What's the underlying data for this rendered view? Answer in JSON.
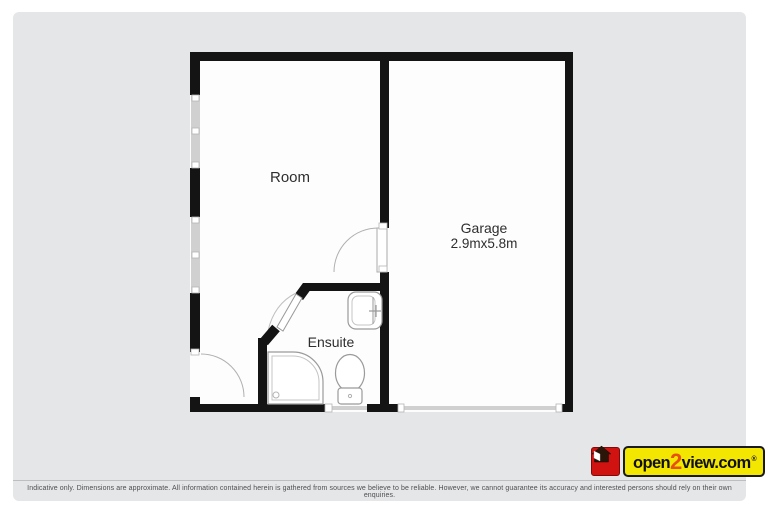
{
  "page": {
    "background": "#ffffff",
    "card_background": "#e5e6e8"
  },
  "floorplan": {
    "rooms": {
      "room": {
        "label": "Room"
      },
      "garage": {
        "label": "Garage",
        "dims": "2.9mx5.8m"
      },
      "ensuite": {
        "label": "Ensuite"
      }
    },
    "icons": [
      "window-icon",
      "door-swing-icon",
      "shower-icon",
      "toilet-icon",
      "sink-icon",
      "garage-door-icon"
    ],
    "colors": {
      "wall": "#141414",
      "window": "#d0d0d0",
      "fixture_outline": "#9a9a9a",
      "floor": "#fdfdfd"
    }
  },
  "branding": {
    "open": "open",
    "two": "2",
    "view": "view.com",
    "reg": "®",
    "colors": {
      "logo_red": "#d01310",
      "logo_yellow": "#f3e600",
      "logo_accent": "#e8500f"
    }
  },
  "footer": {
    "disclaimer": "Indicative only. Dimensions are approximate. All information contained herein is gathered from sources we believe to be reliable. However, we cannot guarantee its accuracy and interested persons should rely on their own enquiries."
  }
}
